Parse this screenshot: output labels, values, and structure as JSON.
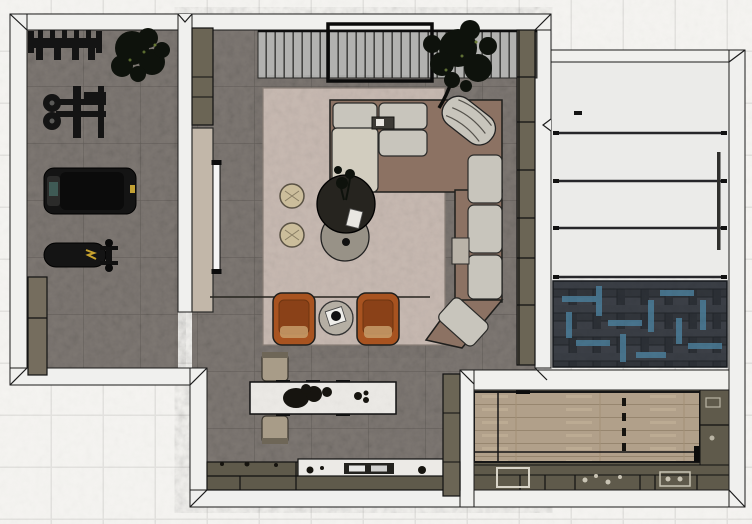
{
  "scene": {
    "kind": "interior-floor-plan-top-view",
    "style": "3d-rendered-plan",
    "rooms": [
      {
        "name": "home-gym",
        "floor": "grey-stone-tile",
        "furniture": [
          "dumbbell-rack",
          "potted-plant",
          "cable-weight-machine",
          "treadmill",
          "weight-bench",
          "storage-cabinet"
        ]
      },
      {
        "name": "living-room",
        "floor": "grey-stone-tile",
        "furniture": [
          "slatted-credenza",
          "wall-art-frame",
          "media-wall-tv",
          "tall-cabinet",
          "area-rug",
          "l-shaped-sectional-sofa",
          "corner-lounge-chair",
          "round-coffee-table-dark",
          "round-coffee-table-low",
          "pouf",
          "pouf",
          "leather-armchair",
          "leather-armchair",
          "round-side-table",
          "kitchen-island",
          "bar-stool",
          "bar-stool",
          "kitchen-counter",
          "cooktop",
          "shelving-strip",
          "potted-tree"
        ]
      },
      {
        "name": "hallway-stairs",
        "floor": "light-panels",
        "furniture": [
          "stair-treads",
          "handrail",
          "herringbone-rug"
        ]
      },
      {
        "name": "utility-room",
        "floor": "dark-cabinetry",
        "furniture": [
          "wood-work-table",
          "lower-cabinets",
          "sink",
          "side-counter"
        ]
      }
    ]
  },
  "colors": {
    "background_tile": "#f5f4f1",
    "tile_grout": "#e3e2df",
    "wall": "#f0f0ee",
    "wall_outline": "#1b1b1b",
    "floor": "#7e7873",
    "rug": "#c8bab2",
    "sofa_frame": "#8c7263",
    "sofa_cushion": "#c8c5bc",
    "sofa_chaise": "#d2cdbf",
    "armchair": "#a85320",
    "armchair_inner": "#8a4118",
    "pouf": "#cbbd9b",
    "table_dark": "#26241f",
    "table_mid": "#989287",
    "side_table": "#b5afa4",
    "island_top": "#eceae6",
    "stool": "#a89c88",
    "counter": "#5f5a4b",
    "counter_marble": "#eceae6",
    "cabinet": "#6b6555",
    "gym_cabinet": "#756d5e",
    "media_panel": "#c2b7a9",
    "tv": "#f5f5f4",
    "credenza": "#b2b2b0",
    "tread": "#ebebe9",
    "tread_line": "#26262a",
    "herringbone": "#363a40",
    "herringbone_accent": "#4c7f9b",
    "wood": "#b1a08a",
    "equipment": "#141414",
    "accent_yellow": "#c2a033",
    "plant": "#0e120c",
    "handrail": "#2f2f2d"
  }
}
